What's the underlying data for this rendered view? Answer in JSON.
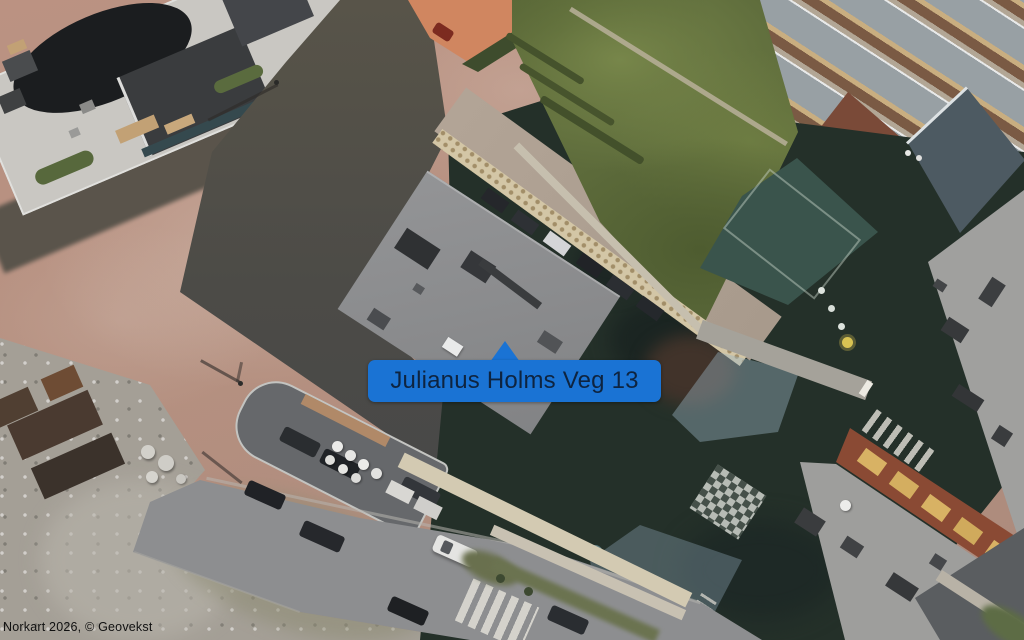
{
  "map": {
    "marker": {
      "label": "Julianus Holms Veg 13",
      "bg_color": "#1a73d4",
      "text_color": "#0e2440",
      "pointer_icon": "triangle-up"
    },
    "attribution": {
      "text": "Norkart 2026, © Geovekst"
    }
  }
}
